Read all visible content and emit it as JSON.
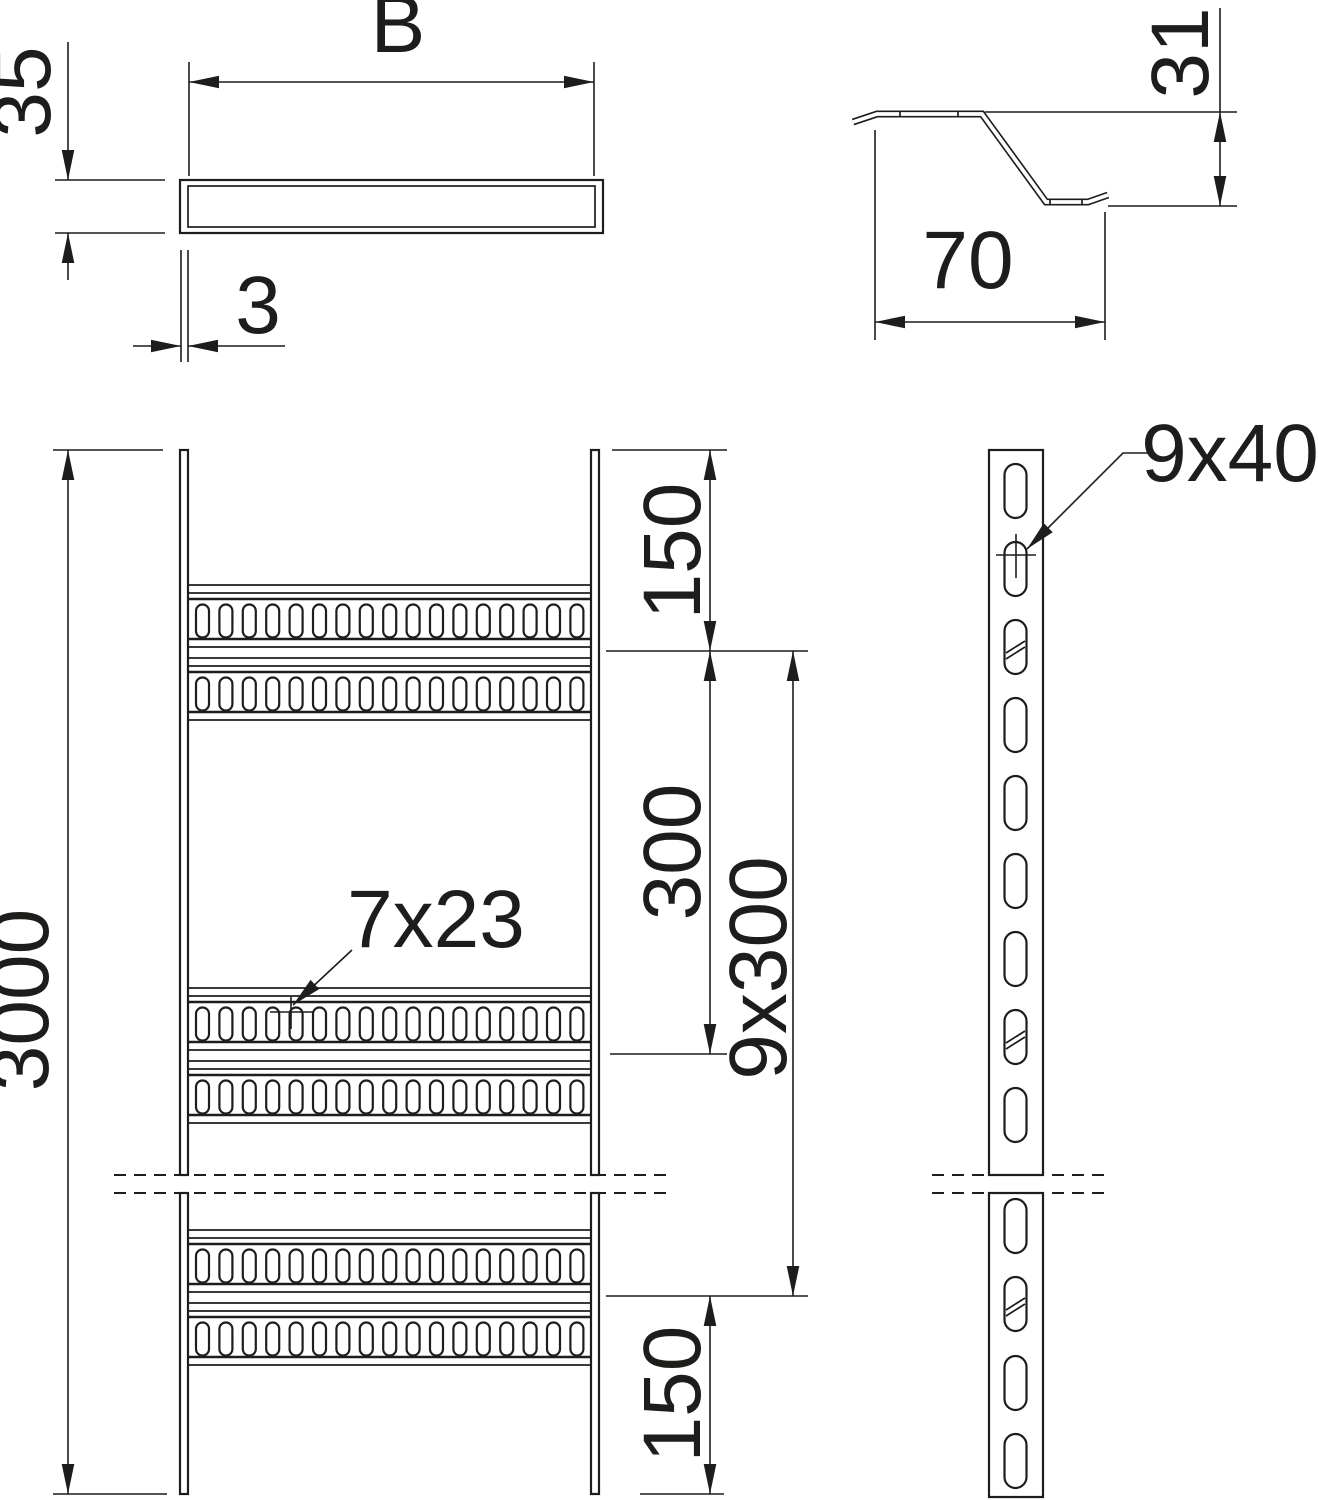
{
  "labels": {
    "tray_width": "B",
    "side_height": "35",
    "wall_thickness": "3",
    "rung_height": "31",
    "rung_width": "70",
    "total_length": "3000",
    "top_end_spacing": "150",
    "rung_spacing": "300",
    "rung_spacing_pattern": "9x300",
    "bottom_end_spacing": "150",
    "rung_slot_size": "7x23",
    "side_slot_size": "9x40"
  },
  "colors": {
    "line": "#1d1d1b",
    "background": "#ffffff"
  }
}
